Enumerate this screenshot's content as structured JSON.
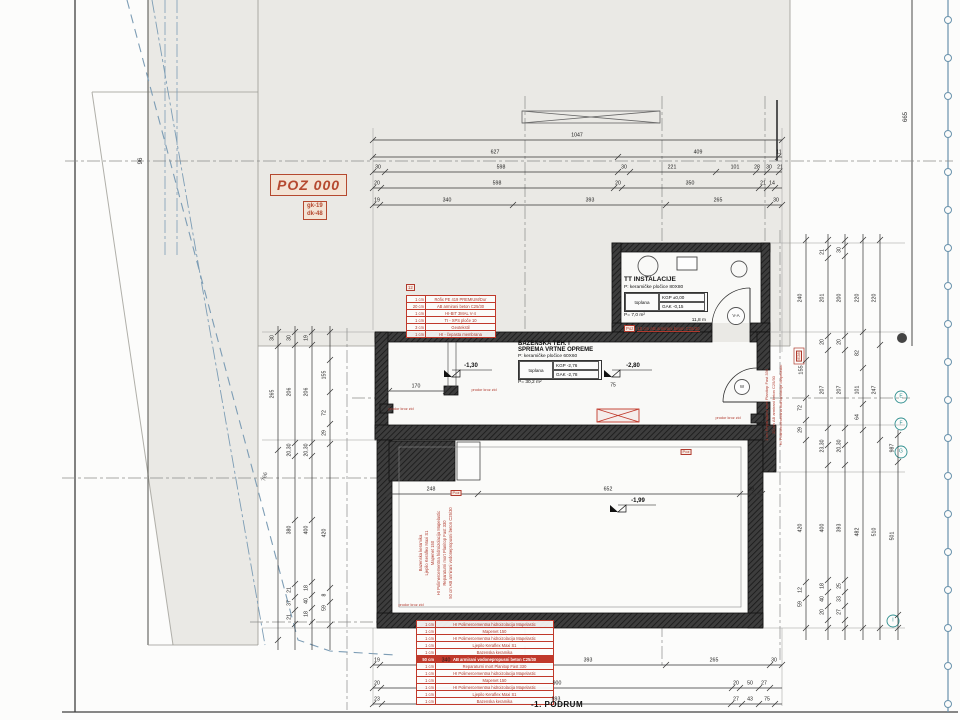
{
  "colors": {
    "red": "#b03a2e",
    "blue": "#7d9db5",
    "teal": "#2f8f8f",
    "gray_site": "#eae9e5",
    "wall": "#3d3d3d"
  },
  "titles": {
    "drawing_title": "-1. PODRUM",
    "poz": "POZ 000",
    "poz_sub1": "gk-19",
    "poz_sub2": "dk-48"
  },
  "rooms": {
    "tt": {
      "name": "TT INSTALACIJE",
      "finish": "P:   keramičke pločice 80X80",
      "cell": "toplana",
      "kgp": "KGP ±0,00",
      "gak": "GAK -0,15",
      "area": "P=   7,0 m²",
      "perimeter": "11,8 m",
      "note_box": "Poz",
      "note": "10 cm AB armirani beton C25/30"
    },
    "baz": {
      "name1": "BAZENSKA TEH. I",
      "name2": "SPREMA VRTNE OPREME",
      "finish": "P:   keramičke pločice 60X60",
      "cell": "toplana",
      "kgp": "KGP -2,76",
      "gak": "GAK -2,78",
      "area": "P=   30,2 m²"
    }
  },
  "tables": {
    "wall_left": {
      "box": "12",
      "rows": [
        {
          "d": "1 cm",
          "m": "Röfix PE 419 PREMIUM/Dur"
        },
        {
          "d": "20 cm",
          "m": "AB armirani beton C25/30"
        },
        {
          "d": "1 cm",
          "m": "HI-BIT 3MAL V-4"
        },
        {
          "d": "1 cm",
          "m": "TI - XPS ploče 10"
        },
        {
          "d": "3 cm",
          "m": "Geotekstil"
        },
        {
          "d": "1 cm",
          "m": "HI - čepasta membrana"
        }
      ]
    },
    "floor_bottom": {
      "rows": [
        {
          "d": "1 cm",
          "m": "HI Polimercementna hidroizolacija Mapelastic"
        },
        {
          "d": "1 cm",
          "m": "Mapenet 150"
        },
        {
          "d": "1 cm",
          "m": "HI Polimercementna hidroizolacija Mapelastic"
        },
        {
          "d": "1 cm",
          "m": "Ljepilo Keraflex Maxi S1"
        },
        {
          "d": "1 cm",
          "m": "Bazenska keramika"
        },
        {
          "d": "50 cm",
          "m": "AB armirani vodonepropusni beton C25/30",
          "hl": true
        },
        {
          "d": "1 cm",
          "m": "Reparaturni mort Planitop Fast 330"
        },
        {
          "d": "1 cm",
          "m": "HI Polimercementna hidroizolacija Mapelastic"
        },
        {
          "d": "1 cm",
          "m": "Mapenet 150"
        },
        {
          "d": "1 cm",
          "m": "HI Polimercementna hidroizolacija Mapelastic"
        },
        {
          "d": "1 cm",
          "m": "Ljepilo Keraflex Maxi S1"
        },
        {
          "d": "1 cm",
          "m": "Bazenska keramika"
        }
      ]
    }
  },
  "dim_chains": [
    {
      "o": "h",
      "y": 140,
      "x1": 373,
      "x2": 782,
      "ticks": [
        373,
        782
      ],
      "labels": [
        {
          "p": 577,
          "t": "1047"
        }
      ]
    },
    {
      "o": "h",
      "y": 157,
      "x1": 373,
      "x2": 782,
      "ticks": [
        373,
        618,
        778
      ],
      "labels": [
        {
          "p": 495,
          "t": "627"
        },
        {
          "p": 698,
          "t": "409"
        },
        {
          "p": 779,
          "t": "11"
        }
      ]
    },
    {
      "o": "h",
      "y": 172,
      "x1": 373,
      "x2": 782,
      "ticks": [
        373,
        385,
        618,
        630,
        716,
        756,
        767,
        779
      ],
      "labels": [
        {
          "p": 378,
          "t": "30"
        },
        {
          "p": 501,
          "t": "598"
        },
        {
          "p": 624,
          "t": "30"
        },
        {
          "p": 672,
          "t": "221"
        },
        {
          "p": 735,
          "t": "101"
        },
        {
          "p": 757,
          "t": "28"
        },
        {
          "p": 769,
          "t": "30"
        },
        {
          "p": 780,
          "t": "21"
        }
      ]
    },
    {
      "o": "h",
      "y": 188,
      "x1": 373,
      "x2": 782,
      "ticks": [
        373,
        381,
        614,
        622,
        759,
        767,
        775
      ],
      "labels": [
        {
          "p": 377,
          "t": "20"
        },
        {
          "p": 497,
          "t": "598"
        },
        {
          "p": 618,
          "t": "20"
        },
        {
          "p": 690,
          "t": "350"
        },
        {
          "p": 763,
          "t": "21"
        },
        {
          "p": 772,
          "t": "14"
        }
      ]
    },
    {
      "o": "h",
      "y": 205,
      "x1": 373,
      "x2": 782,
      "ticks": [
        373,
        380,
        513,
        666,
        770,
        782
      ],
      "labels": [
        {
          "p": 377,
          "t": "19"
        },
        {
          "p": 447,
          "t": "340"
        },
        {
          "p": 590,
          "t": "393"
        },
        {
          "p": 718,
          "t": "265"
        },
        {
          "p": 776,
          "t": "30"
        }
      ]
    },
    {
      "o": "h",
      "y": 665,
      "x1": 373,
      "x2": 782,
      "ticks": [
        373,
        380,
        513,
        666,
        770,
        782
      ],
      "labels": [
        {
          "p": 377,
          "t": "19"
        },
        {
          "p": 446,
          "t": "340"
        },
        {
          "p": 588,
          "t": "393"
        },
        {
          "p": 714,
          "t": "265"
        },
        {
          "p": 774,
          "t": "30"
        }
      ]
    },
    {
      "o": "h",
      "y": 688,
      "x1": 373,
      "x2": 782,
      "ticks": [
        373,
        381,
        732,
        740,
        759,
        770
      ],
      "labels": [
        {
          "p": 377,
          "t": "20"
        },
        {
          "p": 557,
          "t": "900"
        },
        {
          "p": 736,
          "t": "20"
        },
        {
          "p": 750,
          "t": "50"
        },
        {
          "p": 764,
          "t": "27"
        }
      ]
    },
    {
      "o": "h",
      "y": 704,
      "x1": 373,
      "x2": 782,
      "ticks": [
        373,
        382,
        731,
        742,
        759,
        775
      ],
      "labels": [
        {
          "p": 377,
          "t": "23"
        },
        {
          "p": 556,
          "t": "893"
        },
        {
          "p": 736,
          "t": "27"
        },
        {
          "p": 750,
          "t": "43"
        },
        {
          "p": 767,
          "t": "75"
        }
      ]
    },
    {
      "o": "h",
      "y": 494,
      "x1": 389,
      "x2": 762,
      "ticks": [
        389,
        478,
        740,
        762
      ],
      "labels": [
        {
          "p": 431,
          "t": "248"
        },
        {
          "p": 608,
          "t": "652"
        },
        {
          "p": 751,
          "t": "49"
        }
      ]
    },
    {
      "o": "h",
      "y": 391,
      "x1": 389,
      "x2": 446,
      "ticks": [
        389,
        446
      ],
      "labels": [
        {
          "p": 416,
          "t": "170"
        }
      ]
    },
    {
      "o": "v",
      "x": 278,
      "y1": 326,
      "y2": 650,
      "ticks": [
        332,
        346,
        450,
        640
      ],
      "labels": [
        {
          "p": 338,
          "t": "30"
        },
        {
          "p": 394,
          "t": "265"
        }
      ]
    },
    {
      "o": "v",
      "x": 295,
      "y1": 326,
      "y2": 650,
      "ticks": [
        332,
        345,
        443,
        456,
        520,
        584,
        597,
        610,
        624
      ],
      "labels": [
        {
          "p": 338,
          "t": "30"
        },
        {
          "p": 392,
          "t": "206"
        },
        {
          "p": 450,
          "t": "20,30"
        },
        {
          "p": 530,
          "t": "380"
        },
        {
          "p": 590,
          "t": "21"
        },
        {
          "p": 603,
          "t": "37"
        },
        {
          "p": 617,
          "t": "21"
        }
      ]
    },
    {
      "o": "v",
      "x": 312,
      "y1": 326,
      "y2": 650,
      "ticks": [
        332,
        345,
        443,
        456,
        520,
        582,
        595,
        608,
        622
      ],
      "labels": [
        {
          "p": 338,
          "t": "19"
        },
        {
          "p": 392,
          "t": "206"
        },
        {
          "p": 450,
          "t": "20,30"
        },
        {
          "p": 530,
          "t": "400"
        },
        {
          "p": 588,
          "t": "18"
        },
        {
          "p": 601,
          "t": "40"
        },
        {
          "p": 614,
          "t": "18"
        }
      ]
    },
    {
      "o": "v",
      "x": 330,
      "y1": 326,
      "y2": 650,
      "ticks": [
        332,
        360,
        392,
        424,
        444,
        588,
        602,
        625
      ],
      "labels": [
        {
          "p": 375,
          "t": "155"
        },
        {
          "p": 413,
          "t": "72"
        },
        {
          "p": 433,
          "t": "29"
        },
        {
          "p": 533,
          "t": "420"
        },
        {
          "p": 595,
          "t": "8"
        },
        {
          "p": 608,
          "t": "59"
        }
      ]
    },
    {
      "o": "v",
      "x": 806,
      "y1": 234,
      "y2": 640,
      "ticks": [
        240,
        360,
        398,
        420,
        440,
        582,
        598,
        628
      ],
      "labels": [
        {
          "p": 298,
          "t": "240"
        },
        {
          "p": 408,
          "t": "72"
        },
        {
          "p": 430,
          "t": "29"
        },
        {
          "p": 528,
          "t": "420"
        },
        {
          "p": 590,
          "t": "12"
        },
        {
          "p": 604,
          "t": "59"
        }
      ]
    },
    {
      "o": "v",
      "x": 828,
      "y1": 234,
      "y2": 640,
      "ticks": [
        240,
        248,
        258,
        336,
        350,
        428,
        445,
        465,
        580,
        592,
        606,
        620,
        628
      ],
      "labels": [
        {
          "p": 252,
          "t": "21"
        },
        {
          "p": 298,
          "t": "201"
        },
        {
          "p": 342,
          "t": "20"
        },
        {
          "p": 390,
          "t": "207"
        },
        {
          "p": 446,
          "t": "23,30"
        },
        {
          "p": 528,
          "t": "400"
        },
        {
          "p": 586,
          "t": "18"
        },
        {
          "p": 599,
          "t": "40"
        },
        {
          "p": 612,
          "t": "20"
        }
      ]
    },
    {
      "o": "v",
      "x": 845,
      "y1": 234,
      "y2": 640,
      "ticks": [
        240,
        246,
        256,
        336,
        350,
        428,
        445,
        465,
        580,
        592,
        606,
        620,
        628
      ],
      "labels": [
        {
          "p": 250,
          "t": "30"
        },
        {
          "p": 298,
          "t": "200"
        },
        {
          "p": 342,
          "t": "20"
        },
        {
          "p": 390,
          "t": "207"
        },
        {
          "p": 446,
          "t": "20,30"
        },
        {
          "p": 528,
          "t": "393"
        },
        {
          "p": 586,
          "t": "25"
        },
        {
          "p": 599,
          "t": "33"
        },
        {
          "p": 612,
          "t": "27"
        }
      ]
    },
    {
      "o": "v",
      "x": 863,
      "y1": 234,
      "y2": 640,
      "ticks": [
        240,
        332,
        368,
        404,
        430,
        628
      ],
      "labels": [
        {
          "p": 298,
          "t": "220"
        },
        {
          "p": 353,
          "t": "82"
        },
        {
          "p": 390,
          "t": "101"
        },
        {
          "p": 417,
          "t": "64"
        },
        {
          "p": 532,
          "t": "482"
        }
      ]
    },
    {
      "o": "v",
      "x": 880,
      "y1": 234,
      "y2": 640,
      "ticks": [
        240,
        345,
        440,
        628
      ],
      "labels": [
        {
          "p": 298,
          "t": "220"
        },
        {
          "p": 390,
          "t": "247"
        },
        {
          "p": 532,
          "t": "510"
        }
      ]
    },
    {
      "o": "v",
      "x": 898,
      "y1": 430,
      "y2": 640,
      "ticks": [
        435,
        462,
        615,
        628
      ],
      "labels": [
        {
          "p": 448,
          "t": "987"
        },
        {
          "p": 536,
          "t": "501"
        }
      ]
    }
  ],
  "free_labels": [
    {
      "x": 141,
      "y": 161,
      "t": "96",
      "rot": -90,
      "size": 6,
      "c": "#333"
    },
    {
      "x": 906,
      "y": 117,
      "t": "665",
      "rot": -90,
      "size": 6,
      "c": "#333"
    },
    {
      "x": 266,
      "y": 477,
      "t": "766",
      "rot": -75,
      "size": 5.5,
      "c": "#555"
    },
    {
      "x": 471,
      "y": 366,
      "t": "-1,30",
      "size": 6,
      "c": "#111",
      "b": 1
    },
    {
      "x": 633,
      "y": 366,
      "t": "-2,80",
      "size": 6,
      "c": "#111",
      "b": 1
    },
    {
      "x": 613,
      "y": 386,
      "t": "75",
      "size": 5,
      "c": "#222"
    },
    {
      "x": 638,
      "y": 501,
      "t": "-1,99",
      "size": 6,
      "c": "#111",
      "b": 1
    },
    {
      "x": 484,
      "y": 391,
      "t": "prodor kroz zid",
      "size": 3.8,
      "c": "#b03a2e"
    },
    {
      "x": 401,
      "y": 410,
      "t": "prodor kroz zid",
      "size": 3.8,
      "c": "#b03a2e"
    },
    {
      "x": 728,
      "y": 419,
      "t": "prodor kroz zid",
      "size": 3.8,
      "c": "#b03a2e"
    },
    {
      "x": 411,
      "y": 606,
      "t": "prodor kroz zid",
      "size": 3.8,
      "c": "#b03a2e"
    },
    {
      "x": 736,
      "y": 316,
      "t": "V-A",
      "size": 4.5,
      "c": "#333"
    },
    {
      "x": 742,
      "y": 387,
      "t": "W",
      "size": 4.5,
      "c": "#333"
    },
    {
      "x": 901,
      "y": 397,
      "t": "E",
      "size": 5,
      "c": "#2f8f8f"
    },
    {
      "x": 901,
      "y": 424,
      "t": "F",
      "size": 5,
      "c": "#2f8f8f"
    },
    {
      "x": 901,
      "y": 452,
      "t": "G",
      "size": 5,
      "c": "#2f8f8f"
    },
    {
      "x": 893,
      "y": 621,
      "t": "I",
      "size": 5,
      "c": "#2f8f8f"
    },
    {
      "x": 802,
      "y": 370,
      "t": "155",
      "rot": -90,
      "size": 5.5,
      "c": "#222"
    },
    {
      "x": 799,
      "y": 356,
      "t": "E28",
      "rot": -90,
      "size": 4,
      "c": "#b03a2e",
      "box": 1
    },
    {
      "x": 456,
      "y": 493,
      "t": "Poz",
      "size": 4,
      "c": "#b03a2e",
      "box": 1
    },
    {
      "x": 686,
      "y": 452,
      "t": "Poz",
      "size": 4,
      "c": "#b03a2e",
      "box": 1
    },
    {
      "x": 421,
      "y": 553,
      "t": "Bazenska keramika",
      "rot": -90,
      "size": 4.2,
      "c": "#b03a2e"
    },
    {
      "x": 427,
      "y": 553,
      "t": "Ljepilo Keraflex Maxi S1",
      "rot": -90,
      "size": 4.2,
      "c": "#b03a2e"
    },
    {
      "x": 433,
      "y": 553,
      "t": "Mapenet 150",
      "rot": -90,
      "size": 4.2,
      "c": "#b03a2e"
    },
    {
      "x": 439,
      "y": 553,
      "t": "HI Polimercementna hidroizolacija Mapelastic",
      "rot": -90,
      "size": 4.2,
      "c": "#b03a2e"
    },
    {
      "x": 445,
      "y": 553,
      "t": "Reparaturni mort Planitop Fast 330",
      "rot": -90,
      "size": 4.2,
      "c": "#b03a2e"
    },
    {
      "x": 451,
      "y": 553,
      "t": "50 cm AB armirani vodonepropusni beton C25/30",
      "rot": -90,
      "size": 4.2,
      "c": "#b03a2e"
    },
    {
      "x": 767,
      "y": 405,
      "t": "1 cm Reparaturni mort Planitop Fast 330",
      "rot": -90,
      "size": 4,
      "c": "#b03a2e"
    },
    {
      "x": 774,
      "y": 405,
      "t": "20 cm AB armirani beton C25/30",
      "rot": -90,
      "size": 4,
      "c": "#b03a2e"
    },
    {
      "x": 781,
      "y": 405,
      "t": "HI Polimercementna hidroizolacija Mapelastic",
      "rot": -90,
      "size": 4,
      "c": "#b03a2e"
    }
  ]
}
